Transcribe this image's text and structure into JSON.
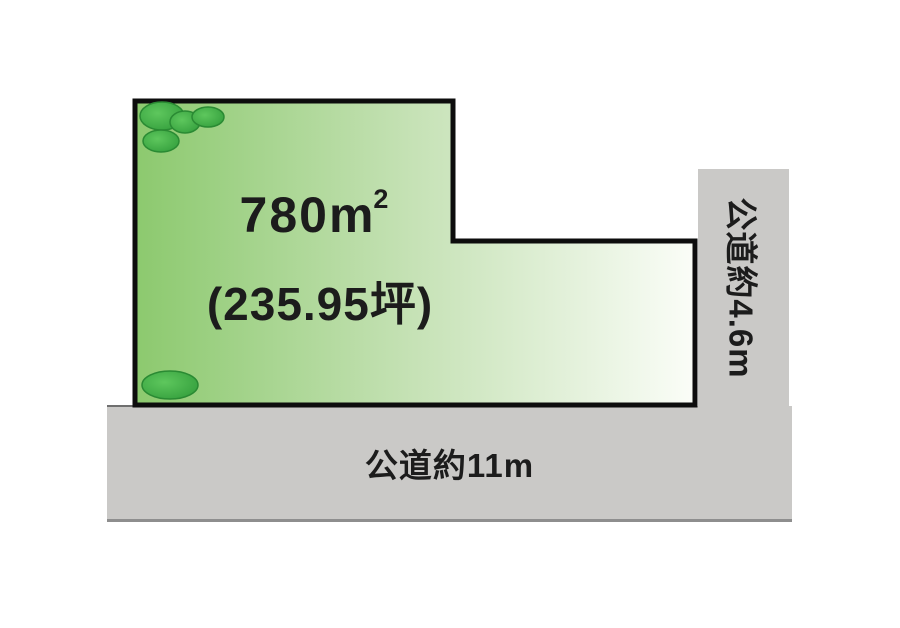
{
  "diagram": {
    "plot": {
      "area_value": "780m",
      "area_superscript": "2",
      "tsubo_value": "(235.95坪)"
    },
    "road_bottom": {
      "label": "公道約11m"
    },
    "road_right": {
      "label": "公道約4.6m"
    }
  },
  "colors": {
    "plot_gradient_start": "#8cc96e",
    "plot_gradient_mid": "#c6e2b6",
    "plot_gradient_end": "#fbfdf8",
    "plot_border": "#0d0d0d",
    "road_fill": "#cac9c7",
    "road_edge": "#8e8e8e",
    "text": "#1c1c1c",
    "tree_light": "#5ec75d",
    "tree_mid": "#2f9a39",
    "tree_dark": "#2a8a33"
  }
}
